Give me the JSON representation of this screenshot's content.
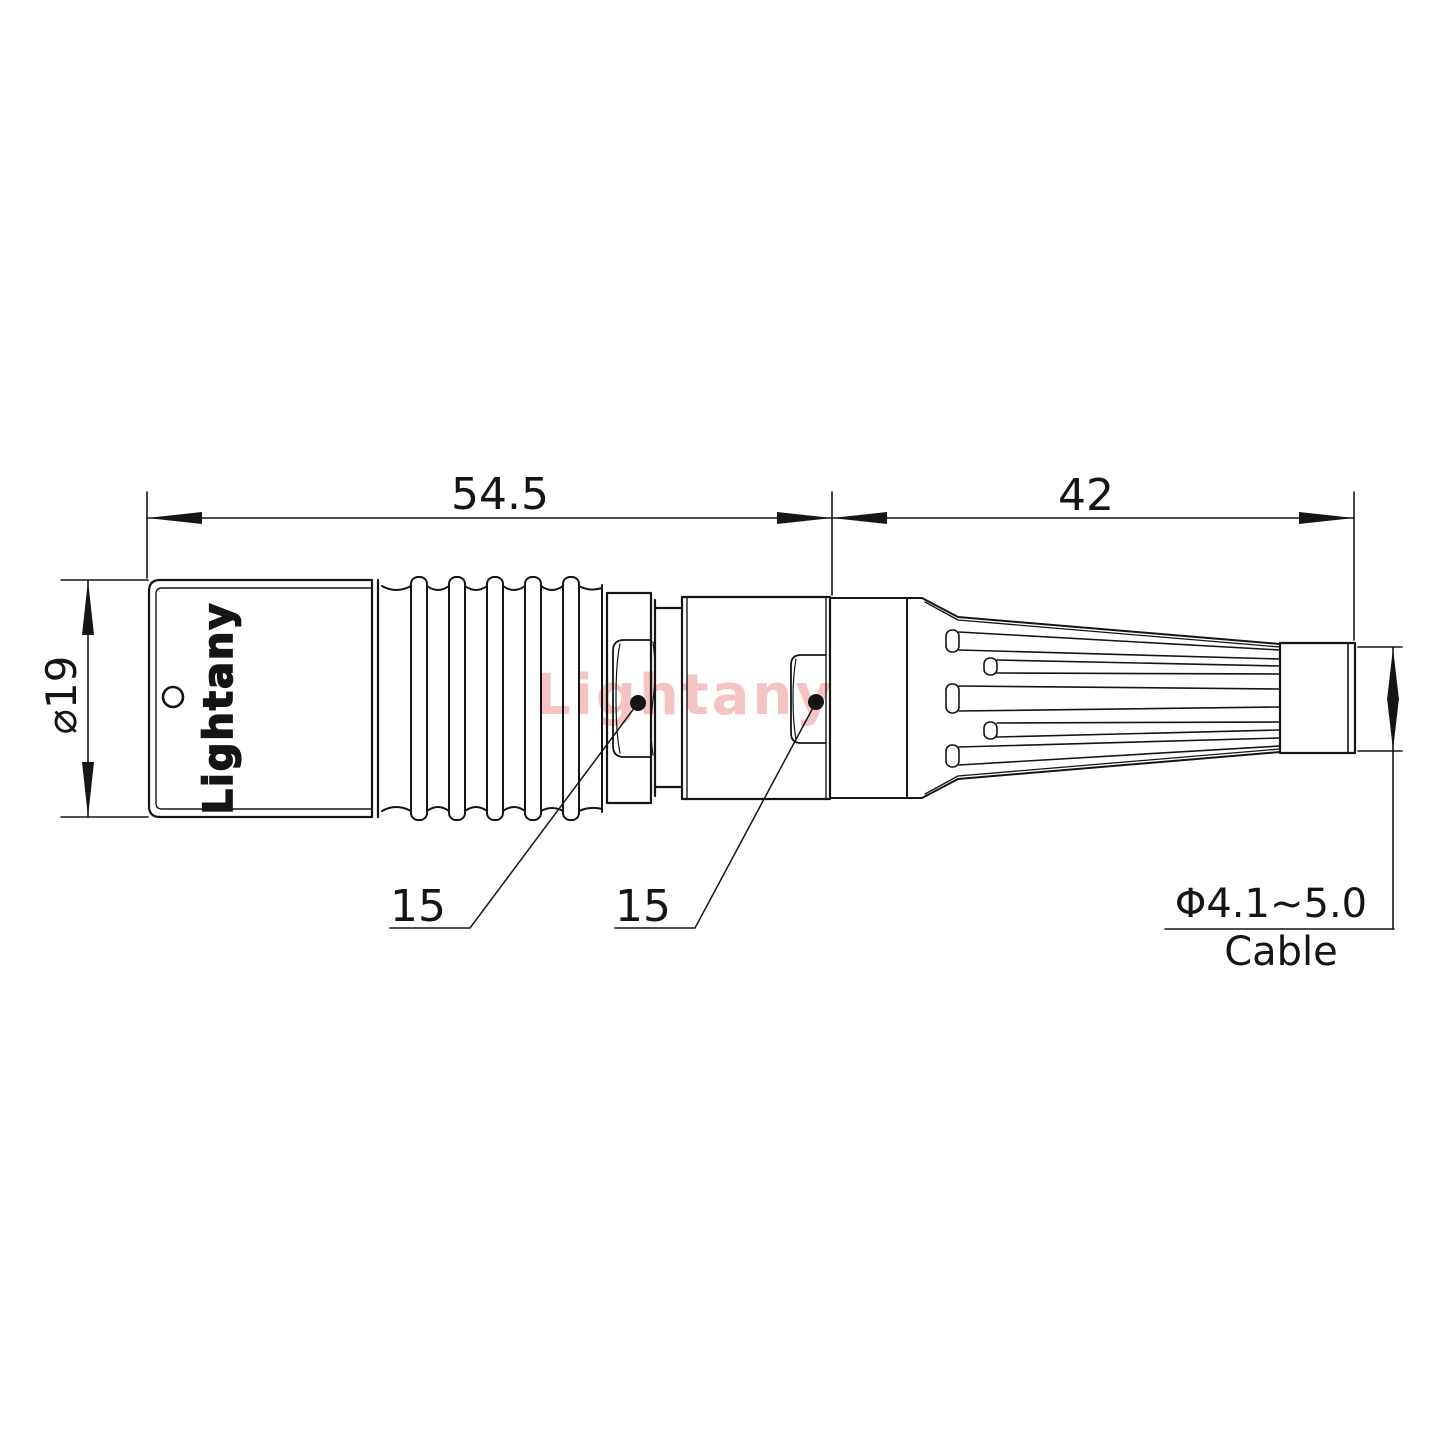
{
  "watermark_text": "Lightany",
  "part_label": "Lightany",
  "dims": {
    "front_length": "54.5",
    "rear_length": "42",
    "diameter": "⌀19",
    "recess_front": "15",
    "recess_rear": "15",
    "cable_range": "Φ4.1~5.0",
    "cable_word": "Cable"
  },
  "colors": {
    "line": "#151515",
    "watermark": "#f4c4c4",
    "background": "#ffffff"
  }
}
